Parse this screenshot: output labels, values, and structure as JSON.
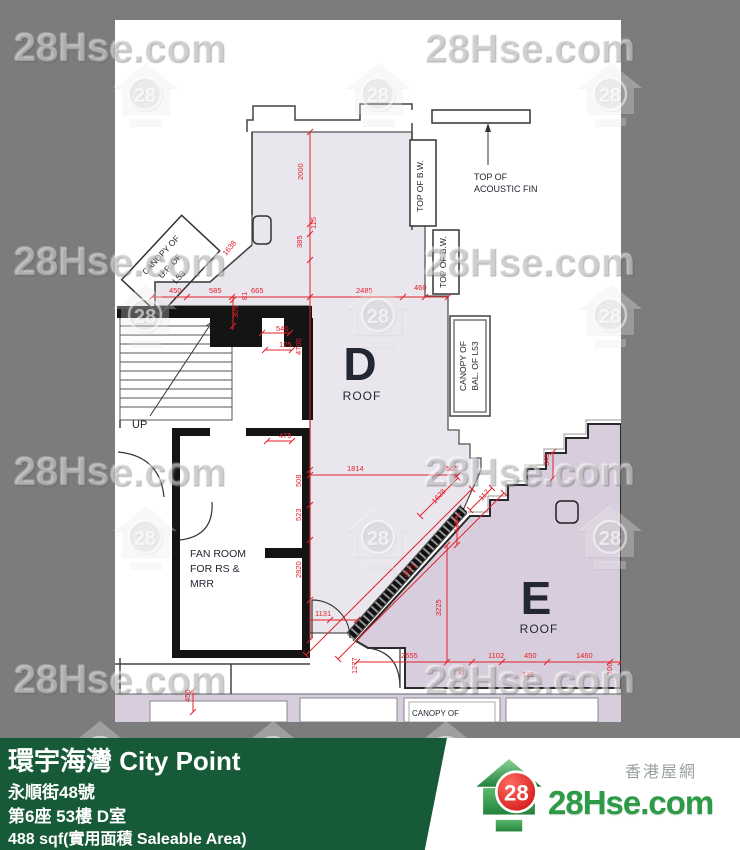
{
  "watermark": {
    "text": "28Hse.com",
    "logo_number": "28",
    "text_positions": [
      [
        14,
        26
      ],
      [
        424,
        26
      ],
      [
        14,
        240
      ],
      [
        424,
        240
      ],
      [
        14,
        450
      ],
      [
        424,
        450
      ],
      [
        14,
        658
      ],
      [
        424,
        658
      ]
    ],
    "logo_positions": [
      [
        145,
        95
      ],
      [
        378,
        95
      ],
      [
        610,
        95
      ],
      [
        145,
        316
      ],
      [
        378,
        316
      ],
      [
        610,
        316
      ],
      [
        145,
        538
      ],
      [
        378,
        538
      ],
      [
        610,
        538
      ],
      [
        100,
        754
      ],
      [
        273,
        754
      ],
      [
        446,
        754
      ]
    ]
  },
  "plan": {
    "labels": [
      {
        "t": "D",
        "x": 360,
        "y": 380,
        "s": 46,
        "a": "middle",
        "w": "600"
      },
      {
        "t": "ROOF",
        "x": 362,
        "y": 400,
        "s": 12,
        "a": "middle",
        "ls": 1
      },
      {
        "t": "E",
        "x": 536,
        "y": 614,
        "s": 46,
        "a": "middle",
        "w": "600"
      },
      {
        "t": "ROOF",
        "x": 539,
        "y": 633,
        "s": 12,
        "a": "middle",
        "ls": 1
      },
      {
        "t": "FAN ROOM",
        "x": 190,
        "y": 557,
        "s": 10.5
      },
      {
        "t": "FOR RS &",
        "x": 190,
        "y": 572,
        "s": 10.5
      },
      {
        "t": "MRR",
        "x": 190,
        "y": 587,
        "s": 10.5
      },
      {
        "t": "UP",
        "x": 132,
        "y": 428,
        "s": 11
      },
      {
        "t": "TOP OF",
        "x": 474,
        "y": 180,
        "s": 9
      },
      {
        "t": "ACOUSTIC FIN",
        "x": 474,
        "y": 192,
        "s": 9
      },
      {
        "t": "TOP OF B.W.",
        "x": 423,
        "y": 186,
        "s": 8.5,
        "r": -90,
        "a": "middle"
      },
      {
        "t": "TOP OF B.W.",
        "x": 446,
        "y": 262,
        "s": 8.5,
        "r": -90,
        "a": "middle"
      },
      {
        "t": "CANOPY OF",
        "x": 466,
        "y": 366,
        "s": 8.5,
        "r": -90,
        "a": "middle"
      },
      {
        "t": "BAL. OF L53",
        "x": 478,
        "y": 366,
        "s": 8.5,
        "r": -90,
        "a": "middle"
      },
      {
        "t": "CANOPY OF",
        "x": 163,
        "y": 257,
        "s": 8.5,
        "r": -47,
        "a": "middle"
      },
      {
        "t": "U.P. OF",
        "x": 172,
        "y": 268,
        "s": 8.5,
        "r": -47,
        "a": "middle"
      },
      {
        "t": "L53",
        "x": 181,
        "y": 279,
        "s": 8.5,
        "r": -47,
        "a": "middle"
      },
      {
        "t": "CANOPY OF",
        "x": 412,
        "y": 716,
        "s": 8
      }
    ],
    "dims": [
      {
        "t": "2000",
        "x": 303,
        "y": 180,
        "r": -90
      },
      {
        "t": "115",
        "x": 316,
        "y": 229,
        "r": -90
      },
      {
        "t": "385",
        "x": 302,
        "y": 248,
        "r": -90
      },
      {
        "t": "450",
        "x": 169,
        "y": 293
      },
      {
        "t": "585",
        "x": 209,
        "y": 293
      },
      {
        "t": "665",
        "x": 251,
        "y": 293
      },
      {
        "t": "2485",
        "x": 356,
        "y": 293
      },
      {
        "t": "460",
        "x": 414,
        "y": 290
      },
      {
        "t": "1638",
        "x": 226,
        "y": 256,
        "r": -50
      },
      {
        "t": "81",
        "x": 247,
        "y": 300,
        "r": -90
      },
      {
        "t": "305",
        "x": 238,
        "y": 318,
        "r": -90
      },
      {
        "t": "540",
        "x": 276,
        "y": 331
      },
      {
        "t": "125",
        "x": 279,
        "y": 347
      },
      {
        "t": "4700",
        "x": 301,
        "y": 355,
        "r": -90
      },
      {
        "t": "475",
        "x": 279,
        "y": 438
      },
      {
        "t": "508",
        "x": 301,
        "y": 487,
        "r": -90
      },
      {
        "t": "523",
        "x": 301,
        "y": 521,
        "r": -90
      },
      {
        "t": "1814",
        "x": 347,
        "y": 471
      },
      {
        "t": "505",
        "x": 446,
        "y": 471
      },
      {
        "t": "345",
        "x": 549,
        "y": 466,
        "r": -90
      },
      {
        "t": "1628",
        "x": 435,
        "y": 504,
        "r": -48
      },
      {
        "t": "117",
        "x": 482,
        "y": 501,
        "r": -48
      },
      {
        "t": "115",
        "x": 459,
        "y": 532,
        "r": -90
      },
      {
        "t": "2820",
        "x": 301,
        "y": 578,
        "r": -90
      },
      {
        "t": "1131",
        "x": 315,
        "y": 616
      },
      {
        "t": "3671",
        "x": 406,
        "y": 578,
        "r": -48
      },
      {
        "t": "3225",
        "x": 441,
        "y": 616,
        "r": -90
      },
      {
        "t": "2655",
        "x": 401,
        "y": 658
      },
      {
        "t": "1102",
        "x": 488,
        "y": 658
      },
      {
        "t": "450",
        "x": 524,
        "y": 658
      },
      {
        "t": "1460",
        "x": 576,
        "y": 658
      },
      {
        "t": "1277",
        "x": 357,
        "y": 674,
        "r": -90
      },
      {
        "t": "63",
        "x": 464,
        "y": 675,
        "r": -90
      },
      {
        "t": "125",
        "x": 522,
        "y": 677
      },
      {
        "t": "100",
        "x": 612,
        "y": 675,
        "r": -90
      },
      {
        "t": "450",
        "x": 190,
        "y": 702,
        "r": -90
      }
    ]
  },
  "footer": {
    "line1": "環宇海灣 City Point",
    "line2": "永順街48號",
    "line3": "第6座 53樓 D室",
    "line4": "488 sqf(實用面積 Saleable Area)"
  },
  "brand": {
    "tagline": "香港屋網",
    "name": "28Hse.com",
    "number": "28"
  }
}
